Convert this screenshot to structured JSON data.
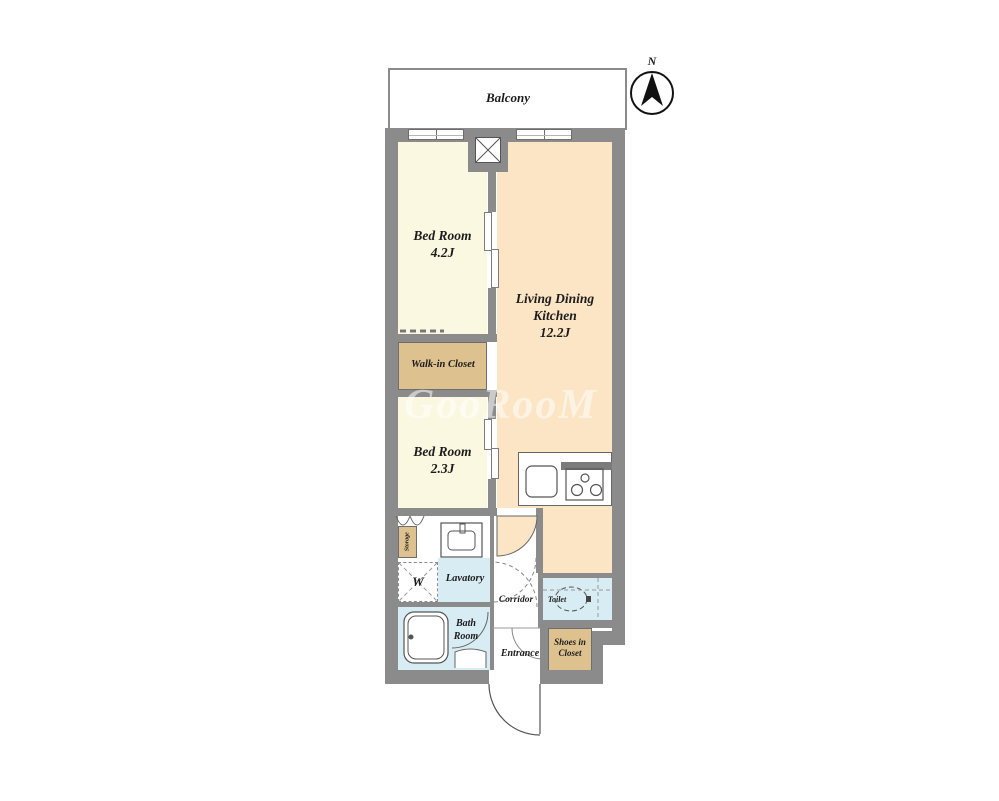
{
  "watermark": {
    "text": "GooRooM"
  },
  "compass": {
    "label": "N"
  },
  "balcony": {
    "label": "Balcony"
  },
  "rooms": {
    "bedroom1": {
      "name": "Bed Room",
      "size": "4.2J"
    },
    "ldk": {
      "line1": "Living Dining",
      "line2": "Kitchen",
      "size": "12.2J"
    },
    "walkin_closet": {
      "label": "Walk-in Closet"
    },
    "bedroom2": {
      "name": "Bed Room",
      "size": "2.3J"
    },
    "storage": {
      "label": "Storage"
    },
    "washer": {
      "label": "W"
    },
    "lavatory": {
      "label": "Lavatory"
    },
    "bathroom": {
      "line1": "Bath",
      "line2": "Room"
    },
    "corridor": {
      "label": "Corridor"
    },
    "toilet": {
      "label": "Toilet"
    },
    "entrance": {
      "label": "Entrance"
    },
    "shoes_closet": {
      "line1": "Shoes in",
      "line2": "Closet"
    }
  },
  "colors": {
    "wall": "#8b8b8b",
    "bedroom_floor": "#faf8e0",
    "ldk_floor": "#fbe5c5",
    "closet_floor": "#ddc18f",
    "wet_area_floor": "#d8ecf3",
    "watermark": "rgba(255,255,255,0.55)"
  }
}
